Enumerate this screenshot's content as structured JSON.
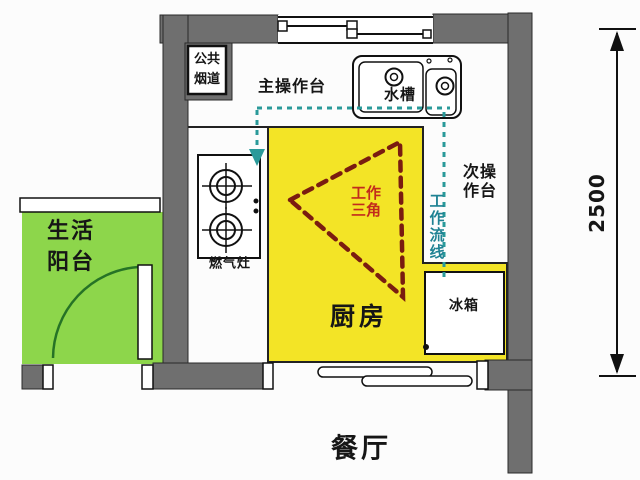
{
  "diagram": {
    "type": "kitchen-floor-plan",
    "rooms": {
      "balcony": "生活\n阳台",
      "kitchen": "厨房",
      "dining": "餐厅"
    },
    "fixtures": {
      "public_flue": "公共\n烟道",
      "main_counter": "主操作台",
      "sink": "水槽",
      "secondary_counter": "次操\n作台",
      "gas_stove": "燃气灶",
      "fridge": "冰箱"
    },
    "annotations": {
      "work_triangle": "工作\n三角",
      "work_flow_line": "工作流线",
      "dimension_right": "2500"
    },
    "colors": {
      "wall": "#6f6f6f",
      "kitchen_floor": "#f3e426",
      "balcony_floor": "#8dd64b",
      "work_triangle": "#7a1c10",
      "work_triangle_text": "#c22b1c",
      "flow_line": "#2a9a9a",
      "flow_text": "#1f8293",
      "door_arc": "#267326",
      "line": "#1a1a1a"
    }
  }
}
